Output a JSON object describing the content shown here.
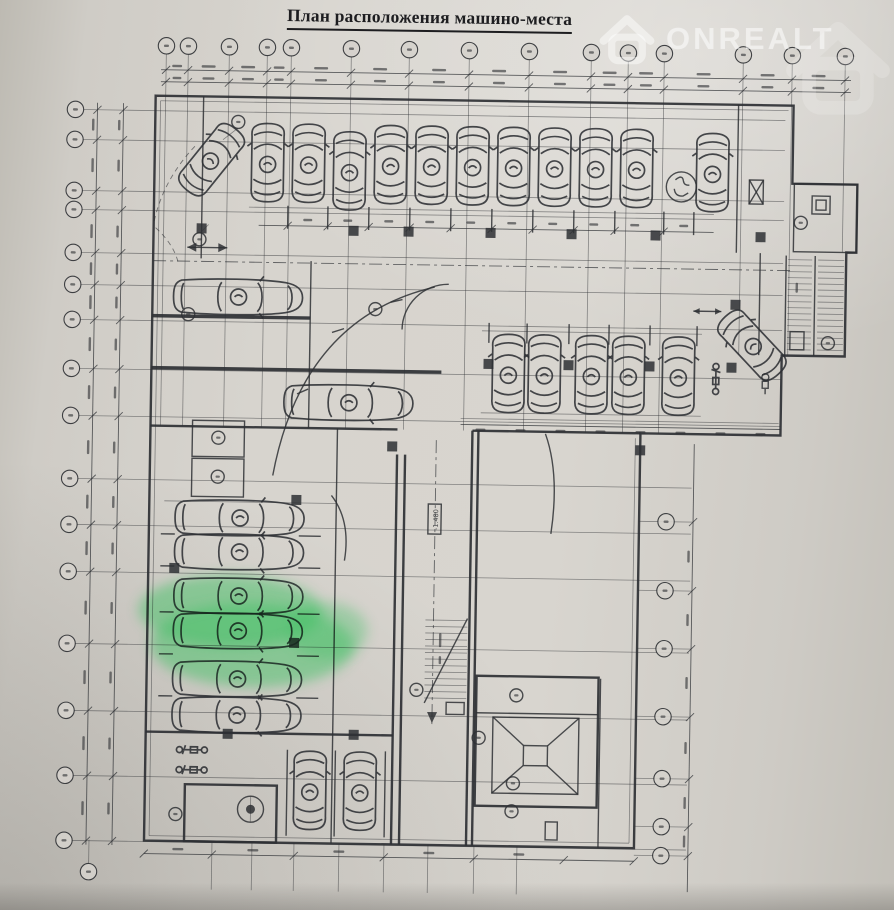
{
  "photo": {
    "title": "План расположения машино-места",
    "watermark_text": "ONREALT",
    "elevation_label": "-1.480",
    "colors": {
      "paper": "#d5d2cc",
      "ink": "#2e3034",
      "highlight_green": "#3fc063",
      "watermark_white": "rgba(255,255,255,0.46)"
    }
  }
}
